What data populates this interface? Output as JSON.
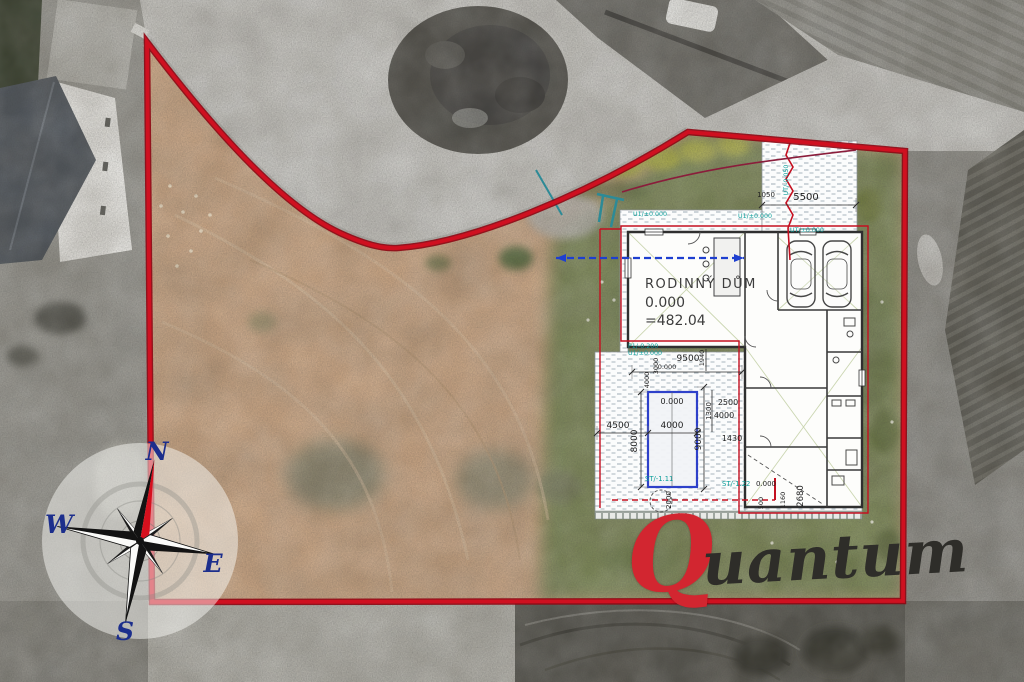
{
  "compass": {
    "north": "N",
    "east": "E",
    "south": "S",
    "west": "W"
  },
  "watermark": {
    "initial": "Q",
    "rest": "uantum"
  },
  "plan": {
    "house": {
      "name": "RODINNÝ DŮM",
      "level": "0.000",
      "altitude": "=482.04"
    },
    "dimensions": [
      "5500",
      "1050",
      "9500",
      "0.000",
      "4000",
      "3000",
      "1940",
      "4500",
      "4000",
      "0.000",
      "8000",
      "9000",
      "1300",
      "2500",
      "4000",
      "1430",
      "2000",
      "500",
      "1160",
      "2680",
      "0.000"
    ],
    "marks": [
      "P1/-0.200",
      "U1/±0.000",
      "U1/±0.000",
      "U1/±0.000",
      "UT/-0.050",
      "UT/±0.000",
      "ST/-1.11",
      "ST/-1.22"
    ]
  },
  "colors": {
    "boundary_red": "#cf1020",
    "plan_red": "#c41020",
    "pool_blue": "#2438c8",
    "utility_teal": "#0b9e9a",
    "compass_navy": "#1c2e8c",
    "logo_red": "#d22630",
    "logo_ink": "#2e2d29",
    "field_tan": "#c9a584",
    "grass_green": "#7b8759"
  }
}
